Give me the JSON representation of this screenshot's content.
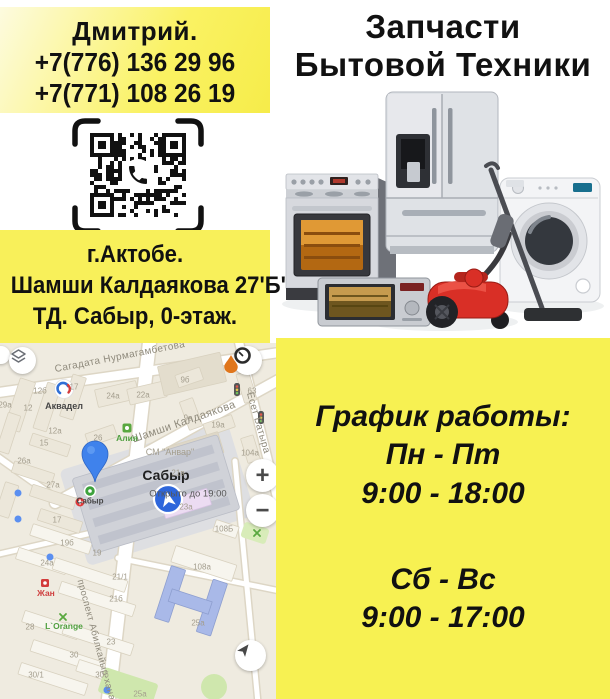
{
  "contact": {
    "name": "Дмитрий.",
    "phones": [
      "+7(776) 136 29 96",
      "+7(771) 108 26 19"
    ]
  },
  "address": {
    "lines": [
      "г.Актобе.",
      "Шамши Калдаякова 27'Б'.",
      "ТД. Сабыр, 0-этаж."
    ]
  },
  "title": {
    "lines": [
      "Запчасти",
      "Бытовой Техники"
    ]
  },
  "schedule": {
    "heading": "График работы:",
    "rows": [
      {
        "days": "Пн - Пт",
        "hours": "9:00 - 18:00"
      },
      {
        "days": "Сб - Вс",
        "hours": "9:00 - 17:00"
      }
    ]
  },
  "map": {
    "controls": {
      "zoom_in": "+",
      "zoom_out": "−"
    },
    "labels": [
      {
        "text": "Сагадата Нурмагамбетова",
        "x": 120,
        "y": 14,
        "rot": -11,
        "cls": "street"
      },
      {
        "text": "Шамши Калдаякова",
        "x": 184,
        "y": 79,
        "rot": -19,
        "cls": "street",
        "size": 11
      },
      {
        "text": "Есет Батыра",
        "x": 258,
        "y": 80,
        "rot": 74,
        "cls": "street"
      },
      {
        "text": "проспект Абилкайыр-хана",
        "x": 96,
        "y": 297,
        "rot": 75,
        "cls": "street",
        "size": 9.5
      },
      {
        "text": "Аквадел",
        "x": 64,
        "y": 63,
        "cls": "poi-dark"
      },
      {
        "text": "Алия",
        "x": 127,
        "y": 95,
        "cls": "poi-green"
      },
      {
        "text": "СМ \"Анвар\"",
        "x": 170,
        "y": 109,
        "cls": "num",
        "size": 9
      },
      {
        "text": "Сабыр",
        "x": 166,
        "y": 132,
        "cls": "place"
      },
      {
        "text": "Открыто до 19:00",
        "x": 188,
        "y": 151,
        "cls": "sub"
      },
      {
        "text": "Сабыр",
        "x": 90,
        "y": 158,
        "cls": "poi-dark",
        "size": 8
      },
      {
        "text": "Жан",
        "x": 46,
        "y": 250,
        "cls": "poi-red"
      },
      {
        "text": "L`Orange",
        "x": 64,
        "y": 283,
        "cls": "poi-green"
      },
      {
        "text": "12б",
        "x": 40,
        "y": 48,
        "cls": "num"
      },
      {
        "text": "17",
        "x": 74,
        "y": 44,
        "cls": "num"
      },
      {
        "text": "12",
        "x": 28,
        "y": 65,
        "cls": "num"
      },
      {
        "text": "29а",
        "x": 5,
        "y": 62,
        "cls": "num"
      },
      {
        "text": "12а",
        "x": 55,
        "y": 88,
        "cls": "num"
      },
      {
        "text": "15",
        "x": 44,
        "y": 100,
        "cls": "num"
      },
      {
        "text": "26а",
        "x": 24,
        "y": 118,
        "cls": "num"
      },
      {
        "text": "26",
        "x": 98,
        "y": 95,
        "cls": "num"
      },
      {
        "text": "27а",
        "x": 53,
        "y": 142,
        "cls": "num"
      },
      {
        "text": "17",
        "x": 57,
        "y": 177,
        "cls": "num"
      },
      {
        "text": "24а",
        "x": 113,
        "y": 53,
        "cls": "num"
      },
      {
        "text": "22а",
        "x": 143,
        "y": 52,
        "cls": "num"
      },
      {
        "text": "9б",
        "x": 185,
        "y": 37,
        "cls": "num"
      },
      {
        "text": "9в",
        "x": 188,
        "y": 75,
        "cls": "num"
      },
      {
        "text": "63",
        "x": 252,
        "y": 48,
        "cls": "num"
      },
      {
        "text": "19а",
        "x": 218,
        "y": 82,
        "cls": "num"
      },
      {
        "text": "104а",
        "x": 250,
        "y": 110,
        "cls": "num"
      },
      {
        "text": "21в",
        "x": 178,
        "y": 130,
        "cls": "num"
      },
      {
        "text": "23а",
        "x": 186,
        "y": 164,
        "cls": "num"
      },
      {
        "text": "24а",
        "x": 47,
        "y": 220,
        "cls": "num"
      },
      {
        "text": "19б",
        "x": 67,
        "y": 200,
        "cls": "num"
      },
      {
        "text": "19",
        "x": 97,
        "y": 210,
        "cls": "num"
      },
      {
        "text": "21/1",
        "x": 120,
        "y": 234,
        "cls": "num"
      },
      {
        "text": "21б",
        "x": 116,
        "y": 256,
        "cls": "num"
      },
      {
        "text": "23",
        "x": 111,
        "y": 299,
        "cls": "num"
      },
      {
        "text": "28",
        "x": 30,
        "y": 284,
        "cls": "num"
      },
      {
        "text": "30",
        "x": 74,
        "y": 312,
        "cls": "num"
      },
      {
        "text": "30/1",
        "x": 36,
        "y": 332,
        "cls": "num"
      },
      {
        "text": "30б",
        "x": 102,
        "y": 332,
        "cls": "num"
      },
      {
        "text": "25а",
        "x": 198,
        "y": 280,
        "cls": "num"
      },
      {
        "text": "108а",
        "x": 202,
        "y": 224,
        "cls": "num"
      },
      {
        "text": "108Б",
        "x": 224,
        "y": 186,
        "cls": "num"
      },
      {
        "text": "25а",
        "x": 140,
        "y": 351,
        "cls": "num"
      }
    ]
  },
  "colors": {
    "accent_yellow": "#f7f152",
    "pin_blue": "#3f82ec",
    "vacuum_red": "#d92f26"
  }
}
